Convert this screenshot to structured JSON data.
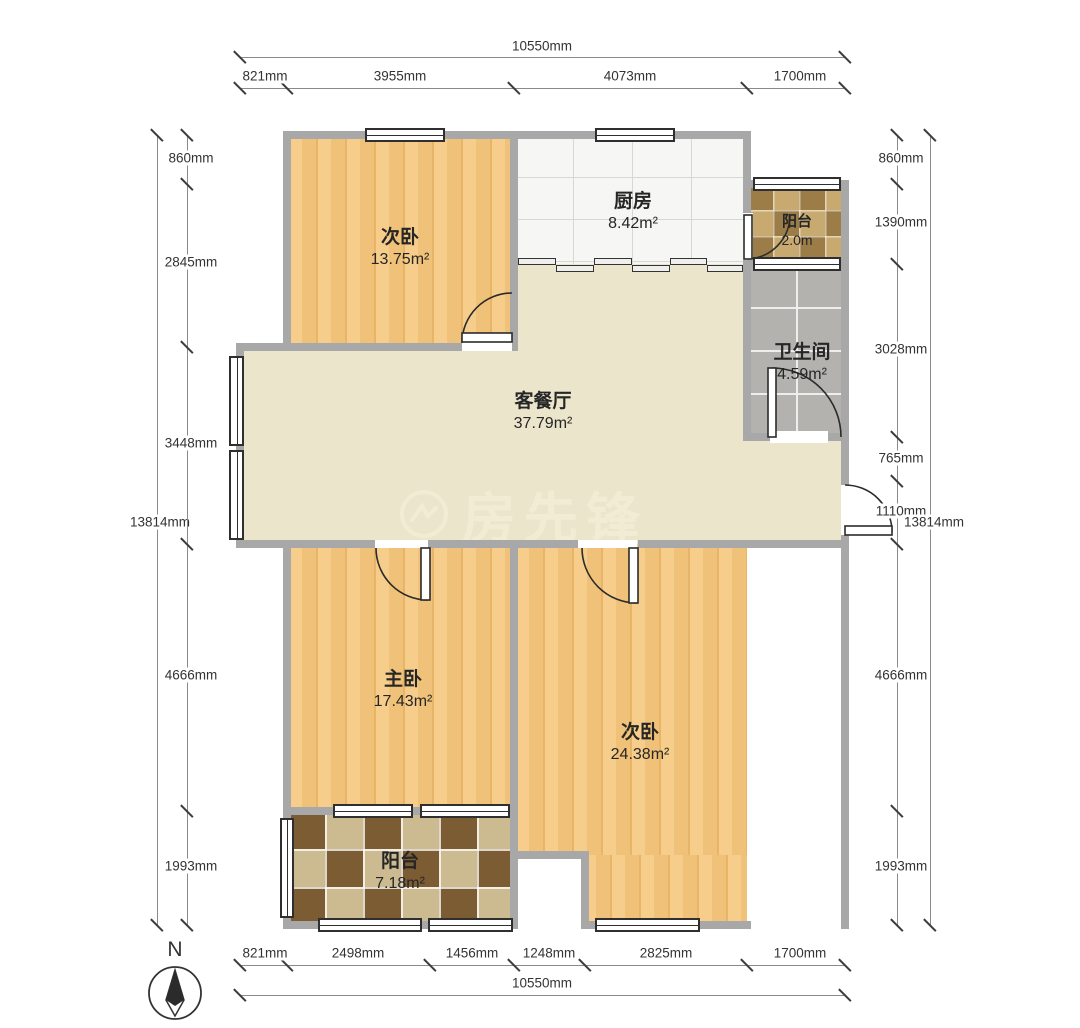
{
  "watermark": {
    "text": "房先锋"
  },
  "compass": {
    "label": "N"
  },
  "rooms": [
    {
      "id": "bedroom-top",
      "name": "次卧",
      "area": "13.75m²"
    },
    {
      "id": "kitchen",
      "name": "厨房",
      "area": "8.42m²"
    },
    {
      "id": "balcony-top",
      "name": "阳台",
      "area": "2.0m"
    },
    {
      "id": "bathroom",
      "name": "卫生间",
      "area": "4.59m²"
    },
    {
      "id": "living-dining",
      "name": "客餐厅",
      "area": "37.79m²"
    },
    {
      "id": "master-bedroom",
      "name": "主卧",
      "area": "17.43m²"
    },
    {
      "id": "bedroom-bottom",
      "name": "次卧",
      "area": "24.38m²"
    },
    {
      "id": "balcony-bottom",
      "name": "阳台",
      "area": "7.18m²"
    }
  ],
  "dimensions": {
    "unit": "mm",
    "top": {
      "total": "10550mm",
      "segments": [
        "821mm",
        "3955mm",
        "4073mm",
        "1700mm"
      ]
    },
    "bottom": {
      "total": "10550mm",
      "segments": [
        "821mm",
        "2498mm",
        "1456mm",
        "1248mm",
        "2825mm",
        "1700mm"
      ]
    },
    "left": {
      "total": "13814mm",
      "segments": [
        "860mm",
        "2845mm",
        "3448mm",
        "4666mm",
        "1993mm"
      ]
    },
    "right": {
      "total": "13814mm",
      "segments": [
        "860mm",
        "1390mm",
        "3028mm",
        "765mm",
        "1110mm",
        "4666mm",
        "1993mm"
      ]
    }
  }
}
